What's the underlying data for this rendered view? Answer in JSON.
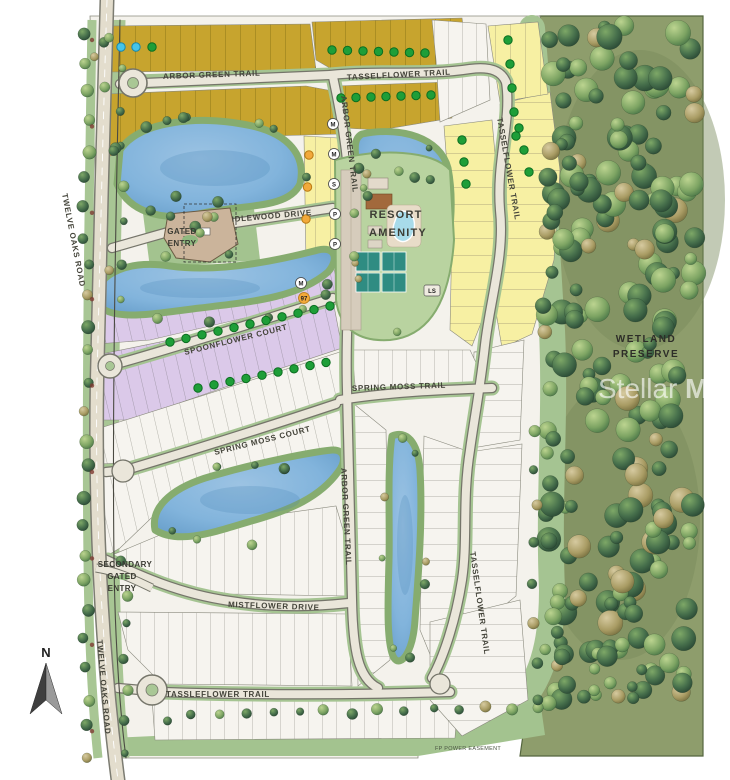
{
  "map": {
    "type": "community-site-plan",
    "streets": {
      "arbor_green_top": "ARBOR GREEN TRAIL",
      "arbor_green_mid": "ARBOR GREEN TRAIL",
      "arbor_green_lower": "ARBOR GREEN TRAIL",
      "tasselflower_top": "TASSELFLOWER TRAIL",
      "tasselflower_right_upper": "TASSELFLOWER TRAIL",
      "tasselflower_right_lower": "TASSELFLOWER TRAIL",
      "tassleflower_bottom": "TASSLEFLOWER TRAIL",
      "idlewood": "IDLEWOOD DRIVE",
      "spoonflower": "SPOONFLOWER COURT",
      "spring_moss_court": "SPRING MOSS COURT",
      "spring_moss_trail": "SPRING MOSS TRAIL",
      "mistflower": "MISTFLOWER DRIVE",
      "twelve_oaks_upper": "TWELVE OAKS ROAD",
      "twelve_oaks_lower": "TWELVE OAKS ROAD"
    },
    "landmarks": {
      "gated_entry_line1": "GATED",
      "gated_entry_line2": "ENTRY",
      "secondary_entry_line1": "SECONDARY",
      "secondary_entry_line2": "GATED",
      "secondary_entry_line3": "ENTRY",
      "resort_line1": "RESORT",
      "resort_line2": "AMENITY",
      "preserve_line1": "WETLAND",
      "preserve_line2": "PRESERVE",
      "power_easement": "FP POWER EASEMENT",
      "north": "N"
    },
    "watermark": {
      "part1": "Stellar",
      "part2": "MLS"
    },
    "badges": [
      {
        "label": "M"
      },
      {
        "label": "M"
      },
      {
        "label": "S"
      },
      {
        "label": "P"
      },
      {
        "label": "P"
      },
      {
        "label": "M"
      },
      {
        "label": "97"
      },
      {
        "label": "LS"
      }
    ],
    "lot_markers": {
      "green_dot_color": "#1E9E38",
      "cyan_dot_color": "#45C4E9",
      "orange_dot_color": "#F2A93B"
    },
    "colors": {
      "olive_lots": "#C7A42E",
      "yellow_lots": "#F7F0A3",
      "purple_lots": "#DBC9E9",
      "white_lots": "#F6F4EF",
      "lake": "#82B4DC",
      "buffer_green": "#A5C492",
      "preserve_green": "#8E9D6C",
      "road_surface": "#EAE6DA",
      "pool": "#A8DBEA",
      "tennis_court": "#2F8C82"
    }
  }
}
